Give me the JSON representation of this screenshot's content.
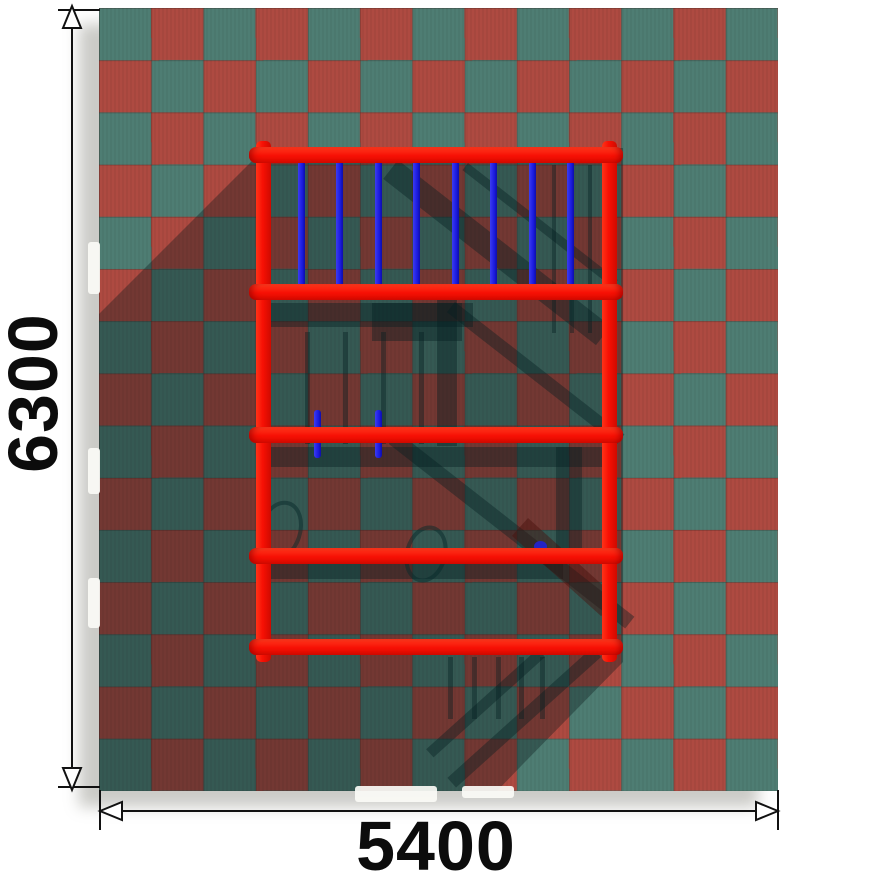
{
  "title": "Playground equipment top-view installation drawing",
  "dimensions": {
    "vertical": {
      "label": "6300"
    },
    "horizontal": {
      "label": "5400"
    }
  },
  "mat": {
    "pattern": "checkerboard",
    "tiles_x": 13,
    "tiles_y": 15
  },
  "equipment": {
    "name": "climbing frame",
    "bar_count": 5,
    "rung_count": 8,
    "peg_count": 2
  },
  "colors": {
    "tile_teal": "#4e7d73",
    "tile_red": "#ae4a41",
    "frame_red": "#f71004",
    "rung_blue": "#1b1bdf",
    "dim_line": "#111111"
  }
}
